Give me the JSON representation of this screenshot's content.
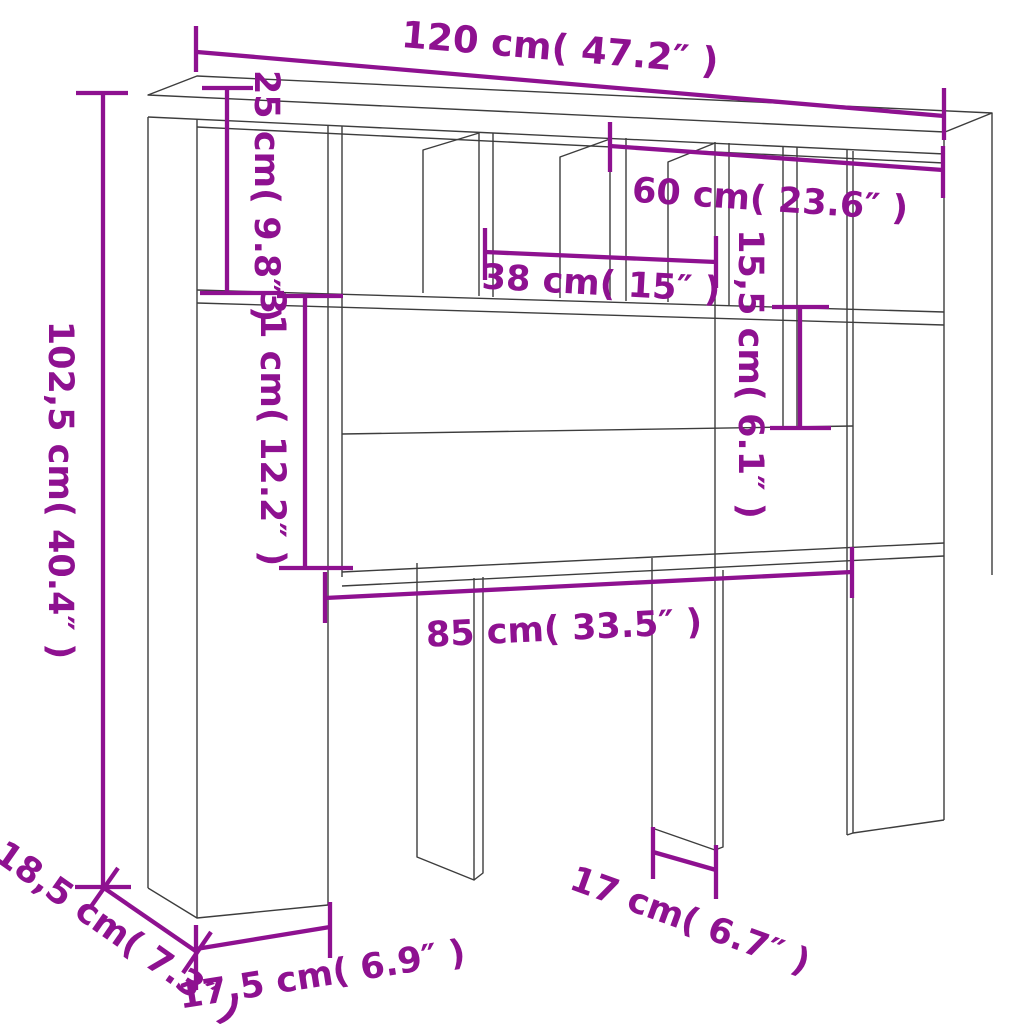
{
  "diagram": {
    "kind": "product dimension diagram",
    "subject": "headboard storage cabinet line drawing with dimension annotations",
    "background_color": "#FFFFFF",
    "outline_color": "#3D3D3D",
    "dimension_color": "#8E1190",
    "dimensions": [
      {
        "part": "overall-width",
        "cm": "120",
        "inches": "47.2",
        "label": "120 cm( 47.2″ )"
      },
      {
        "part": "top-left-compartment-height",
        "cm": "25",
        "inches": "9.8",
        "label": "25 cm( 9.8″ )"
      },
      {
        "part": "top-right-section-width",
        "cm": "60",
        "inches": "23.6",
        "label": "60 cm( 23.6″ )"
      },
      {
        "part": "center-compartment-width",
        "cm": "38",
        "inches": "15",
        "label": "38 cm( 15″ )"
      },
      {
        "part": "right-compartment-height",
        "cm": "15,5",
        "inches": "6.1",
        "label": "15,5 cm( 6.1″ )"
      },
      {
        "part": "open-shelf-height",
        "cm": "31",
        "inches": "12.2",
        "label": "31 cm( 12.2″ )"
      },
      {
        "part": "overall-height",
        "cm": "102,5",
        "inches": "40.4",
        "label": "102,5 cm( 40.4″ )"
      },
      {
        "part": "bottom-opening-width",
        "cm": "85",
        "inches": "33.5",
        "label": "85 cm( 33.5″ )"
      },
      {
        "part": "leg-gap-width",
        "cm": "17",
        "inches": "6.7",
        "label": "17 cm( 6.7″ )"
      },
      {
        "part": "left-leg-width",
        "cm": "17,5",
        "inches": "6.9",
        "label": "17,5 cm( 6.9″ )"
      },
      {
        "part": "depth",
        "cm": "18,5",
        "inches": "7.3",
        "label": "18,5 cm( 7.3″ )"
      }
    ]
  }
}
